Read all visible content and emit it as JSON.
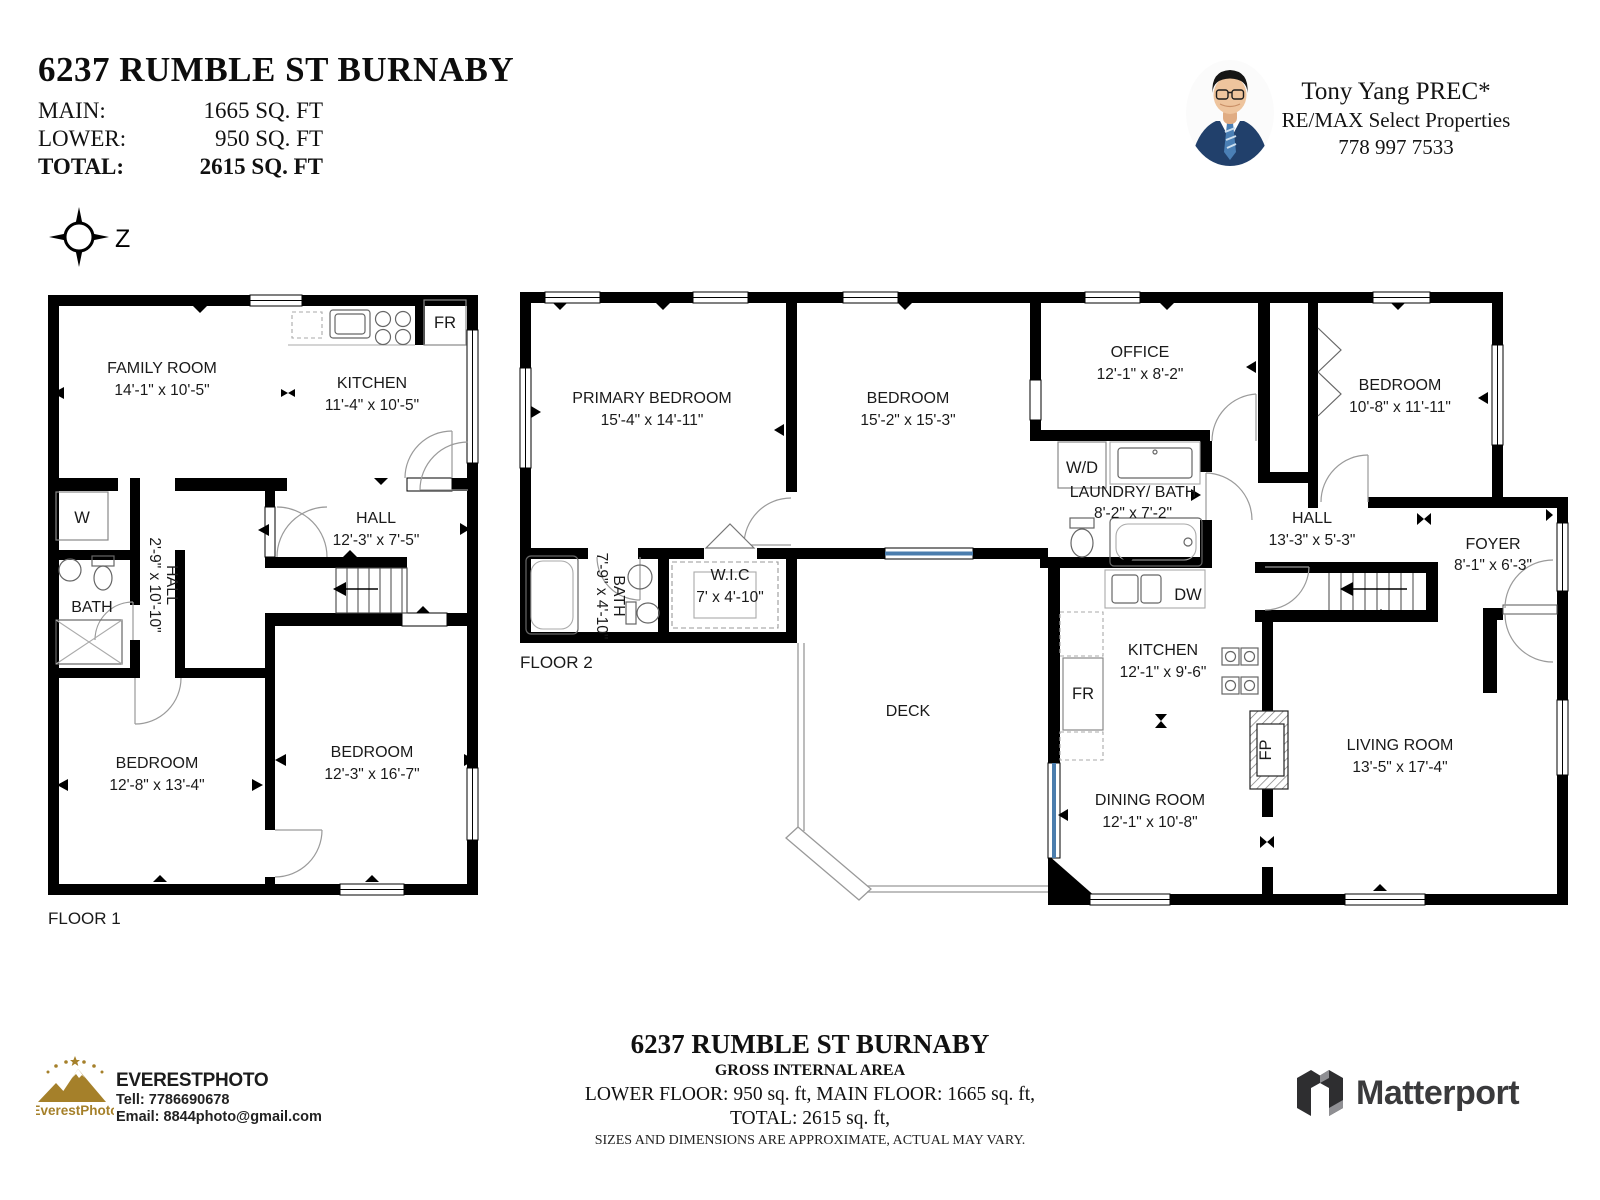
{
  "header": {
    "title": "6237 RUMBLE ST BURNABY",
    "areas": [
      {
        "label": "MAIN:",
        "value": "1665 SQ. FT"
      },
      {
        "label": "LOWER:",
        "value": "950 SQ. FT"
      },
      {
        "label": "TOTAL:",
        "value": "2615 SQ. FT"
      }
    ]
  },
  "agent": {
    "name": "Tony Yang PREC*",
    "company": "RE/MAX Select Properties",
    "phone": "778 997 7533"
  },
  "compass": {
    "north": "Z"
  },
  "floor1": {
    "label": "FLOOR 1",
    "rooms": [
      {
        "name": "FAMILY ROOM",
        "dims": "14'-1\" x 10'-5\""
      },
      {
        "name": "KITCHEN",
        "dims": "11'-4\" x 10'-5\""
      },
      {
        "name": "HALL",
        "dims": "12'-3\" x 7'-5\""
      },
      {
        "name": "HALL",
        "dims": "2'-9\" x 10'-10\""
      },
      {
        "name": "BATH",
        "dims": ""
      },
      {
        "name": "BEDROOM",
        "dims": "12'-8\" x 13'-4\""
      },
      {
        "name": "BEDROOM",
        "dims": "12'-3\" x 16'-7\""
      }
    ],
    "appliances": {
      "fridge": "FR",
      "washer": "W"
    }
  },
  "floor2": {
    "label": "FLOOR 2",
    "rooms": [
      {
        "name": "PRIMARY BEDROOM",
        "dims": "15'-4\" x 14'-11\""
      },
      {
        "name": "BEDROOM",
        "dims": "15'-2\" x 15'-3\""
      },
      {
        "name": "OFFICE",
        "dims": "12'-1\" x 8'-2\""
      },
      {
        "name": "BEDROOM",
        "dims": "10'-8\" x 11'-11\""
      },
      {
        "name": "BATH",
        "dims": "7'-9\" x 4'-10\""
      },
      {
        "name": "W.I.C",
        "dims": "7' x 4'-10\""
      },
      {
        "name": "LAUNDRY/ BATH",
        "dims": "8'-2\" x 7'-2\""
      },
      {
        "name": "HALL",
        "dims": "13'-3\" x 5'-3\""
      },
      {
        "name": "FOYER",
        "dims": "8'-1\" x 6'-3\""
      },
      {
        "name": "KITCHEN",
        "dims": "12'-1\" x 9'-6\""
      },
      {
        "name": "DINING ROOM",
        "dims": "12'-1\" x 10'-8\""
      },
      {
        "name": "LIVING ROOM",
        "dims": "13'-5\" x 17'-4\""
      },
      {
        "name": "DECK",
        "dims": ""
      }
    ],
    "appliances": {
      "washer_dryer": "W/D",
      "fridge": "FR",
      "dishwasher": "DW",
      "fireplace": "FP"
    }
  },
  "footer": {
    "photographer": {
      "logo": "EverestPhoto",
      "brand": "EVERESTPHOTO",
      "tel": "Tell: 7786690678",
      "email": "Email: 8844photo@gmail.com"
    },
    "summary": {
      "title": "6237 RUMBLE ST BURNABY",
      "subtitle": "GROSS INTERNAL AREA",
      "line1": "LOWER FLOOR: 950 sq. ft,  MAIN FLOOR: 1665 sq. ft,",
      "line2": "TOTAL: 2615 sq. ft,",
      "disclaimer": "SIZES AND DIMENSIONS ARE APPROXIMATE, ACTUAL MAY VARY."
    },
    "matterport": "Matterport"
  },
  "colors": {
    "wall": "#000000",
    "glass_accent": "#4b7dad",
    "logo_gold": "#a5802a",
    "matterport_gray": "#3a3a3c"
  }
}
